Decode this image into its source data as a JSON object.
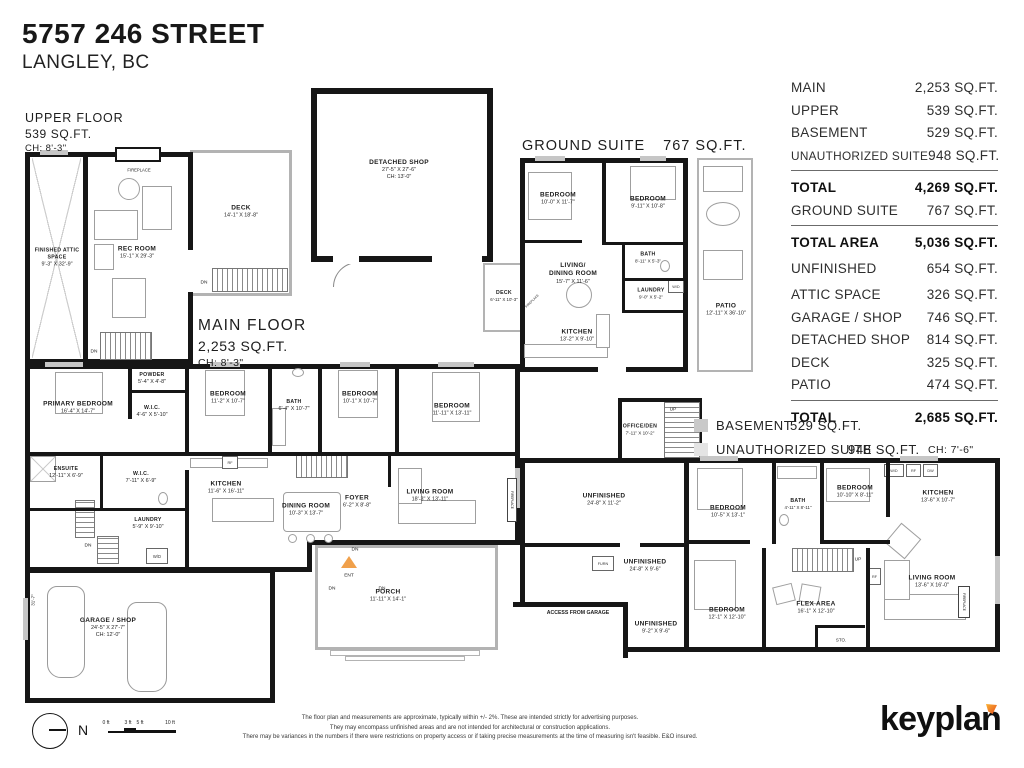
{
  "title": {
    "address": "5757 246 STREET",
    "city": "LANGLEY, BC"
  },
  "colors": {
    "wall": "#161616",
    "deck_outline": "#b3b3b3",
    "basement_fill": "#c9c9c9",
    "suite_fill": "#e4e4e4",
    "ent_marker": "#f0a04b",
    "logo_accent": "#e84e1b"
  },
  "area_table": {
    "rows": [
      {
        "label": "MAIN",
        "value": "2,253 SQ.FT."
      },
      {
        "label": "UPPER",
        "value": "539 SQ.FT."
      },
      {
        "label": "BASEMENT",
        "value": "529 SQ.FT."
      },
      {
        "label": "UNAUTHORIZED SUITE",
        "value": "948 SQ.FT."
      },
      {
        "label": "TOTAL",
        "value": "4,269 SQ.FT."
      },
      {
        "label": "GROUND SUITE",
        "value": "767 SQ.FT."
      },
      {
        "label": "TOTAL AREA",
        "value": "5,036 SQ.FT."
      },
      {
        "label": "UNFINISHED",
        "value": "654 SQ.FT."
      },
      {
        "label": "ATTIC SPACE",
        "value": "326 SQ.FT."
      },
      {
        "label": "GARAGE / SHOP",
        "value": "746 SQ.FT."
      },
      {
        "label": "DETACHED SHOP",
        "value": "814 SQ.FT."
      },
      {
        "label": "DECK",
        "value": "325 SQ.FT."
      },
      {
        "label": "PATIO",
        "value": "474 SQ.FT."
      },
      {
        "label": "TOTAL",
        "value": "2,685 SQ.FT."
      }
    ]
  },
  "plans": {
    "upper_floor": {
      "title": "UPPER FLOOR",
      "area": "539 SQ.FT.",
      "ch": "CH: 8'-3\""
    },
    "main_floor": {
      "title": "MAIN FLOOR",
      "area": "2,253 SQ.FT.",
      "ch": "CH: 8'-3\""
    },
    "ground_suite": {
      "title": "GROUND SUITE",
      "area": "767 SQ.FT."
    }
  },
  "legend": {
    "basement_label": "BASEMENT",
    "basement_area": "529 SQ.FT.",
    "suite_label": "UNAUTHORIZED SUITE",
    "suite_area": "948 SQ.FT.",
    "suite_ch": "CH: 7'-6\""
  },
  "rooms": {
    "upper": [
      {
        "name": "FINISHED ATTIC SPACE",
        "dims": "9'-3\" X 32'-9\""
      },
      {
        "name": "REC ROOM",
        "dims": "15'-1\" X 29'-3\""
      },
      {
        "name": "DECK",
        "dims": "14'-1\" X 18'-8\""
      }
    ],
    "main": [
      {
        "name": "PRIMARY BEDROOM",
        "dims": "16'-4\" X 14'-7\""
      },
      {
        "name": "POWDER",
        "dims": "5'-4\" X 4'-8\""
      },
      {
        "name": "W.I.C.",
        "dims": "4'-6\" X 5'-10\""
      },
      {
        "name": "BEDROOM",
        "dims": "11'-2\" X 10'-7\""
      },
      {
        "name": "BATH",
        "dims": "6'-4\" X 10'-7\""
      },
      {
        "name": "BEDROOM",
        "dims": "10'-1\" X 10'-7\""
      },
      {
        "name": "BEDROOM",
        "dims": "11'-11\" X 13'-11\""
      },
      {
        "name": "ENSUITE",
        "dims": "12'-11\" X 6'-9\""
      },
      {
        "name": "W.I.C.",
        "dims": "7'-11\" X 6'-9\""
      },
      {
        "name": "KITCHEN",
        "dims": "11'-6\" X 16'-11\""
      },
      {
        "name": "LAUNDRY",
        "dims": "5'-9\" X 9'-10\""
      },
      {
        "name": "DINING ROOM",
        "dims": "10'-3\" X 13'-7\""
      },
      {
        "name": "FOYER",
        "dims": "6'-2\" X 8'-8\""
      },
      {
        "name": "LIVING ROOM",
        "dims": "18'-3\" X 13'-11\""
      },
      {
        "name": "PORCH",
        "dims": "11'-11\" X 14'-1\""
      },
      {
        "name": "GARAGE / SHOP",
        "dims": "24'-5\" X 27'-7\"",
        "ch": "CH: 12'-0\""
      }
    ],
    "shop": {
      "name": "DETACHED SHOP",
      "dims": "27'-5\" X 27'-6\"",
      "ch": "CH: 13'-0\""
    },
    "shop_deck": {
      "name": "DECK",
      "dims": "6'-11\" X 10'-3\""
    },
    "suite": [
      {
        "name": "BEDROOM",
        "dims": "10'-0\" X 11'-7\""
      },
      {
        "name": "BEDROOM",
        "dims": "9'-11\" X 10'-8\""
      },
      {
        "name": "BATH",
        "dims": "8'-11\" X 5'-3\""
      },
      {
        "name": "LIVING/",
        "name2": "DINING ROOM",
        "dims": "15'-7\" X 11'-6\""
      },
      {
        "name": "LAUNDRY",
        "dims": "9'-0\" X 5'-2\""
      },
      {
        "name": "KITCHEN",
        "dims": "13'-2\" X 9'-10\""
      },
      {
        "name": "PATIO",
        "dims": "12'-11\" X 36'-10\""
      }
    ],
    "basement": [
      {
        "name": "OFFICE/DEN",
        "dims": "7'-11\" X 10'-2\""
      },
      {
        "name": "UNFINISHED",
        "dims": "24'-8\" X 11'-2\""
      },
      {
        "name": "UNFINISHED",
        "dims": "24'-8\" X 9'-6\""
      },
      {
        "name": "UNFINISHED",
        "dims": "9'-2\" X 9'-6\""
      },
      {
        "name": "BEDROOM",
        "dims": "10'-5\" X 13'-1\""
      },
      {
        "name": "BEDROOM",
        "dims": "12'-1\" X 12'-10\""
      },
      {
        "name": "BATH",
        "dims": "4'-11\" X 8'-11\""
      },
      {
        "name": "BEDROOM",
        "dims": "10'-10\" X 8'-11\""
      },
      {
        "name": "KITCHEN",
        "dims": "13'-6\" X 10'-7\""
      },
      {
        "name": "LIVING ROOM",
        "dims": "13'-6\" X 16'-0\""
      },
      {
        "name": "FLEX AREA",
        "dims": "16'-1\" X 12'-10\""
      }
    ]
  },
  "markers": {
    "dn": "DN",
    "up": "UP",
    "ent": "ENT",
    "wd": "W/D",
    "rf": "RF",
    "dw": "DW",
    "furn": "FURN",
    "sto": "STO.",
    "fireplace": "FIREPLACE",
    "access": "ACCESS FROM GARAGE",
    "north": "N",
    "garage_depth": "31'-7\""
  },
  "scale": {
    "labels": [
      "0 ft",
      "3 ft",
      "5 ft",
      "10 ft"
    ]
  },
  "footer": {
    "disclaimer": [
      "The floor plan and measurements are approximate, typically within +/- 2%. These are intended strictly for advertising purposes.",
      "They may encompass unfinished areas and are not intended for architectural or construction applications.",
      "There may be variances in the numbers if there were restrictions on property access or if taking precise measurements at the time of measuring isn't feasible. E&O insured."
    ],
    "logo": "keyplan"
  }
}
